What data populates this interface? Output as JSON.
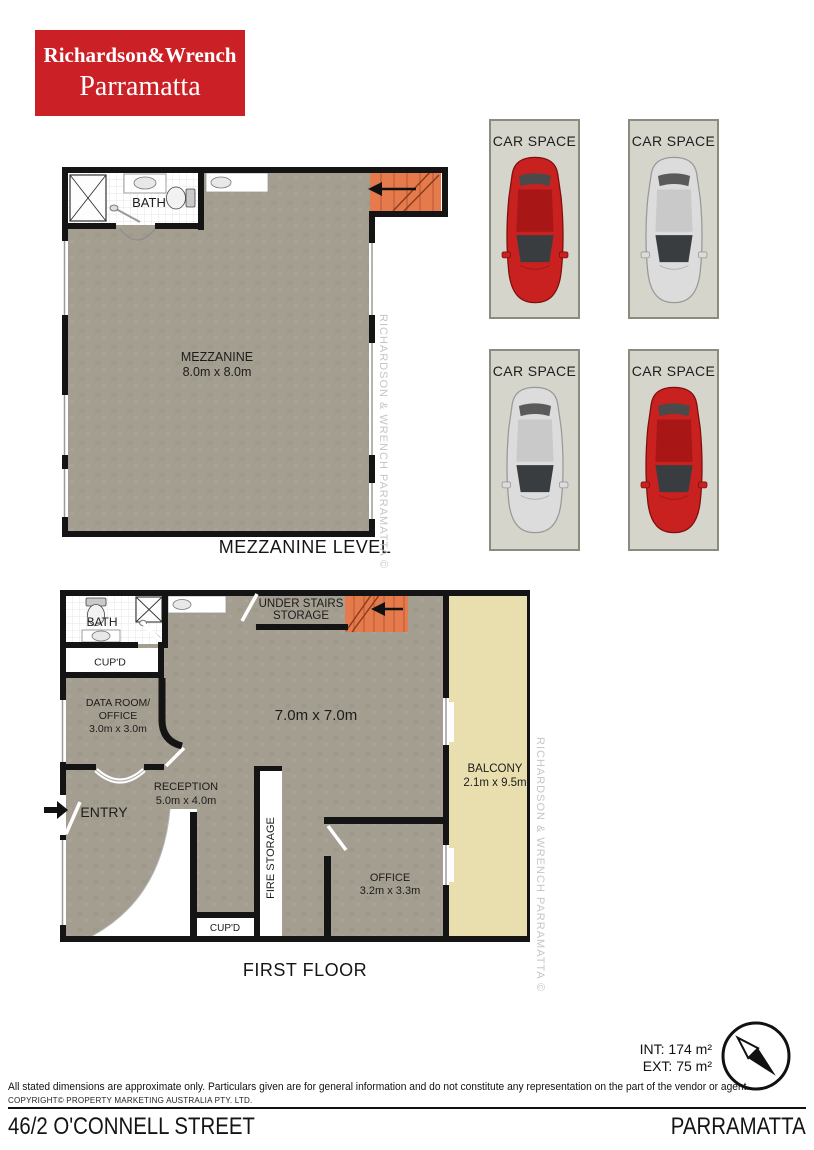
{
  "logo": {
    "line1": "Richardson&Wrench",
    "line2": "Parramatta"
  },
  "mezzanine": {
    "bath_label": "BATH",
    "room_label": "MEZZANINE",
    "room_dims": "8.0m x 8.0m",
    "caption": "MEZZANINE LEVEL"
  },
  "car_spaces": {
    "label": "CAR SPACE",
    "spaces": [
      {
        "car": "red"
      },
      {
        "car": "silver"
      },
      {
        "car": "silver"
      },
      {
        "car": "red"
      }
    ]
  },
  "first_floor": {
    "bath_label": "BATH",
    "cupd_top_label": "CUP'D",
    "data_room_line1": "DATA ROOM/",
    "data_room_line2": "OFFICE",
    "data_room_dims": "3.0m x 3.0m",
    "under_stairs_line1": "UNDER STAIRS",
    "under_stairs_line2": "STORAGE",
    "main_dims": "7.0m x 7.0m",
    "reception_label": "RECEPTION",
    "reception_dims": "5.0m x 4.0m",
    "entry_label": "ENTRY",
    "fire_storage_label": "FIRE STORAGE",
    "office_label": "OFFICE",
    "office_dims": "3.2m x 3.3m",
    "cupd_bottom_label": "CUP'D",
    "balcony_label": "BALCONY",
    "balcony_dims": "2.1m x 9.5m",
    "caption": "FIRST FLOOR"
  },
  "footer": {
    "int_area": "INT: 174 m²",
    "ext_area": "EXT: 75 m²",
    "disclaimer": "All stated dimensions are approximate only. Particulars given are for general information and do not constitute any representation on the part of the vendor or agent.",
    "copyright": "COPYRIGHT© PROPERTY MARKETING AUSTRALIA PTY. LTD.",
    "address_street": "46/2 O'CONNELL STREET",
    "address_suburb": "PARRAMATTA"
  },
  "watermark": {
    "text": "RICHARDSON & WRENCH PARRAMATTA ©"
  },
  "colors": {
    "brand_red": "#cb2026",
    "floor": "#a49e91",
    "balcony": "#e9dfae",
    "stairs": "#e57a4c",
    "car_space_bg": "#d5d5cb",
    "car_red": "#c92120",
    "car_red_dark": "#a81616",
    "car_silver": "#dcdcdc",
    "car_silver_dark": "#c9c9c9",
    "glass": "#3a3d40",
    "watermark": "#c6c6c6"
  }
}
